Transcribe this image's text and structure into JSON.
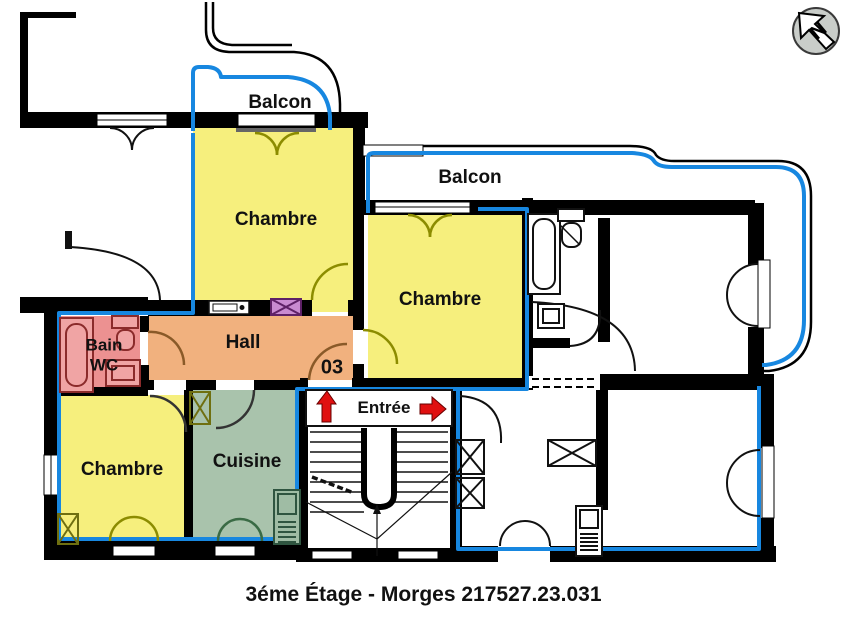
{
  "floor_plan": {
    "caption": "3éme Étage - Morges 217527.23.031",
    "unit_number": "03",
    "compass_letter": "N",
    "rooms": {
      "balcony_top": {
        "label": "Balcon"
      },
      "balcony_mid": {
        "label": "Balcon"
      },
      "bedroom_top": {
        "label": "Chambre"
      },
      "bedroom_mid": {
        "label": "Chambre"
      },
      "bedroom_bottom": {
        "label": "Chambre"
      },
      "hall": {
        "label": "Hall"
      },
      "bathroom": {
        "label_line1": "Bain",
        "label_line2": "WC"
      },
      "kitchen": {
        "label": "Cuisine"
      },
      "entrance": {
        "label": "Entrée"
      }
    },
    "colors": {
      "apartment_outline_blue": "#1787E0",
      "bedroom_yellow": "#F6EF7D",
      "hall_orange": "#F1B17E",
      "bathroom_pink": "#EC9191",
      "kitchen_green": "#A9C3AC",
      "entrance_arrow_red": "#E01010",
      "door_swing_olive": "#8C8C00",
      "bathroom_fixture_red": "#8B2B2B",
      "shaft_purple": "#C98BD1"
    }
  }
}
